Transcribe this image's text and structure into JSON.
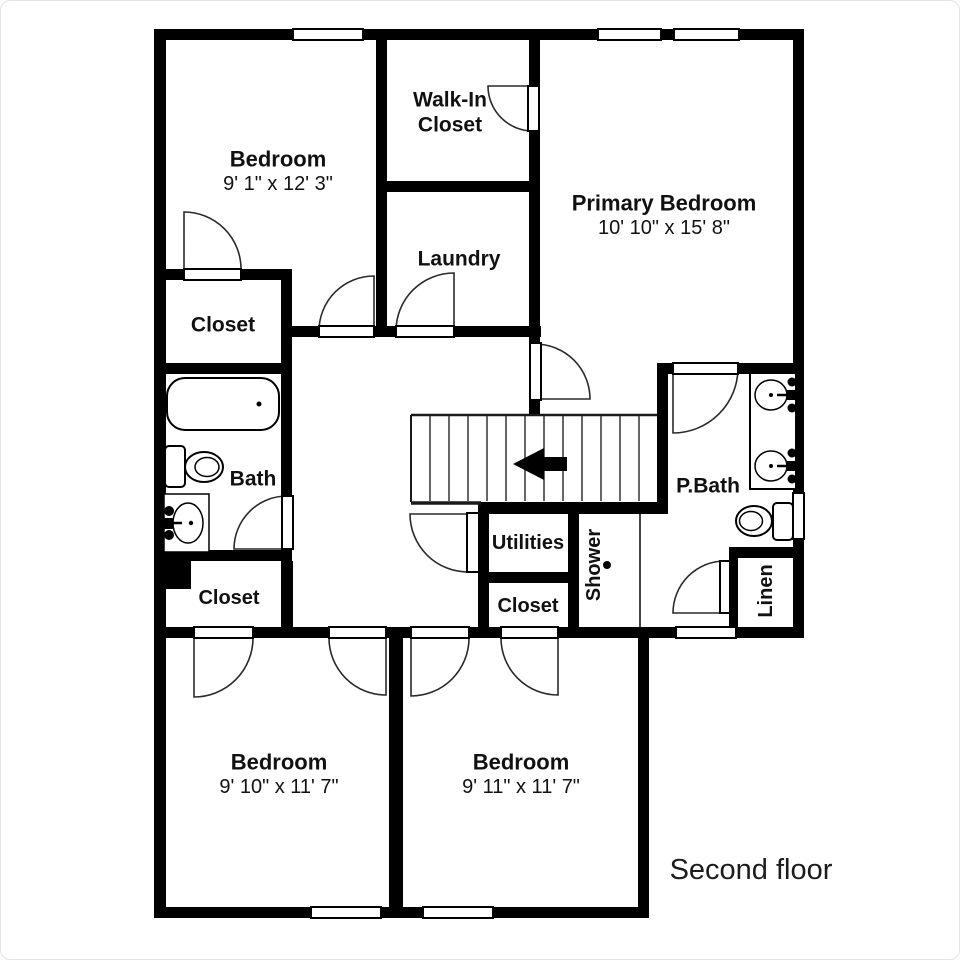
{
  "page": {
    "background": "#ffffff",
    "border_color": "#e3e3e3"
  },
  "plan": {
    "floor_label": "Second floor",
    "colors": {
      "wall": "#000000",
      "floor": "#ffffff",
      "text": "#111111"
    },
    "rooms": {
      "bedroom_top_left": {
        "label": "Bedroom",
        "dims": "9' 1\" x 12' 3\""
      },
      "walk_in_closet": {
        "label_line1": "Walk-In",
        "label_line2": "Closet"
      },
      "laundry": {
        "label": "Laundry"
      },
      "primary_bedroom": {
        "label": "Primary Bedroom",
        "dims": "10' 10\" x 15' 8\""
      },
      "closet_top_left": {
        "label": "Closet"
      },
      "bath": {
        "label": "Bath"
      },
      "closet_mid_left": {
        "label": "Closet"
      },
      "utilities": {
        "label": "Utilities"
      },
      "closet_middle": {
        "label": "Closet"
      },
      "shower": {
        "label": "Shower"
      },
      "primary_bath": {
        "label": "P.Bath"
      },
      "linen": {
        "label": "Linen"
      },
      "bedroom_bottom_left": {
        "label": "Bedroom",
        "dims": "9' 10\" x 11' 7\""
      },
      "bedroom_bottom_right": {
        "label": "Bedroom",
        "dims": "9' 11\" x 11' 7\""
      }
    }
  }
}
